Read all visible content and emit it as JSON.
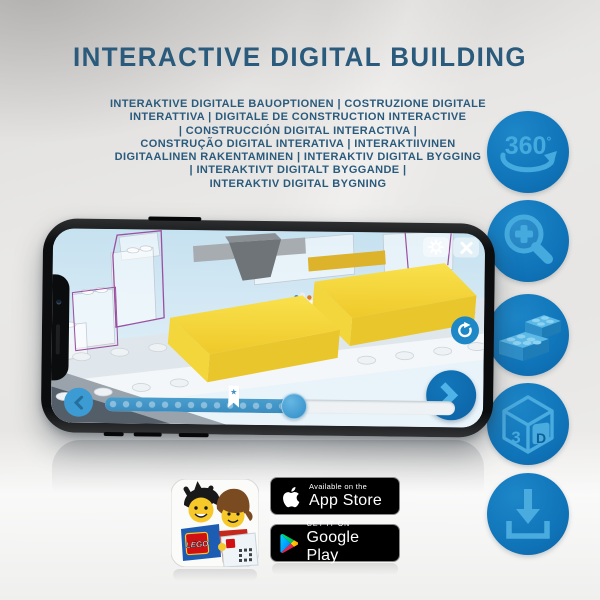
{
  "header": {
    "title": "INTERACTIVE DIGITAL BUILDING",
    "subtitle_lines": [
      "INTERAKTIVE DIGITALE BAUOPTIONEN | COSTRUZIONE DIGITALE",
      "INTERATTIVA | DIGITALE DE CONSTRUCTION INTERACTIVE",
      "| CONSTRUCCIÓN DIGITAL INTERACTIVA |",
      "CONSTRUÇÃO DIGITAL INTERATIVA | INTERAKTIIVINEN",
      "DIGITAALINEN RAKENTAMINEN | INTERAKTIV DIGITAL BYGGING",
      "| INTERAKTIVT DIGITALT BYGGANDE |",
      "INTERAKTIV DIGITAL BYGNING"
    ]
  },
  "features": [
    {
      "icon": "360-rotation-icon",
      "number": "360",
      "degree": "°"
    },
    {
      "icon": "zoom-in-icon"
    },
    {
      "icon": "lego-bricks-icon"
    },
    {
      "icon": "3d-cube-icon",
      "left": "3",
      "right": "D"
    },
    {
      "icon": "download-icon"
    }
  ],
  "phone": {
    "bookmark_star": "★"
  },
  "app_icon": {
    "logo_text": "LEGO"
  },
  "badges": {
    "app_store": {
      "tagline": "Available on the",
      "name": "App Store"
    },
    "google_play": {
      "tagline": "GET IT ON",
      "name": "Google Play"
    }
  },
  "colors": {
    "title_blue": "#2a5a7c",
    "circle_blue": "#1074b9",
    "icon_light_blue": "#45aade",
    "phone_frame": "#0b0c0d",
    "screen_sky": "#cde6f3",
    "lego_yellow": "#f3d433",
    "slider_blue": "#3e92c6",
    "selection_purple": "#9b4fa0",
    "badge_black": "#000000"
  }
}
